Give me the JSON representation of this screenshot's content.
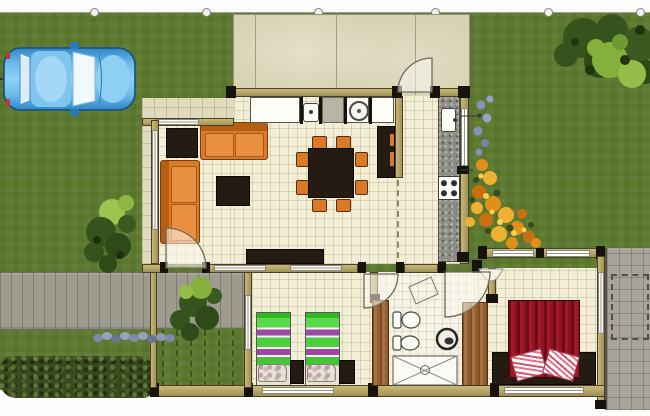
{
  "scene": {
    "kind": "residential site / floor plan, top-down colour render",
    "visible_text": "none",
    "canvas": {
      "width": 650,
      "height": 416
    }
  },
  "palette": {
    "grass": "#5d7a2f",
    "hedge": "#394920",
    "walkway": "#9d9a8e",
    "terrace": "#d8d3b4",
    "floor_tile": "#f3efd7",
    "wall_wood": "#b3a263",
    "column_dark": "#17130c",
    "sofa_orange": "#d97a28",
    "dark_furniture": "#241c12",
    "kitchen_counter": "#8d8e86",
    "car_blue": "#4aa2e0",
    "flower_orange": "#e09018",
    "bed_green": "#46d334",
    "bed_purple": "#9d48a4",
    "bed_red": "#8e1420",
    "door_wood": "#a9713f",
    "rear_patio": "#a8a49b"
  },
  "site": {
    "boundary_marker_count": 6,
    "car": "blue sedan parked on lawn, top-left",
    "walkway": "grey paved path from west boundary to front door",
    "hedge": "dark shrub hedge, lower-left",
    "shrub_row": "grey-blue shrubs along south edge of walkway",
    "west_tree": "tree beside west facade",
    "northeast_tree": "tree in north-east lawn corner",
    "flower_bed": "orange flower bed against east kitchen wall",
    "courtyard": "planted courtyard with pergola battens south of living room",
    "rear_patio": "grey paved patio east of master bedroom with dashed layout rectangle"
  },
  "house": {
    "terrace": {
      "label": "north terrace",
      "doors": [
        "kitchen swing door"
      ]
    },
    "living_room": {
      "furniture": [
        "corner table",
        "two-seat sofa (north)",
        "two-seat sofa (west)",
        "coffee table",
        "low TV sideboard"
      ]
    },
    "dining_area": {
      "furniture": [
        "square dark table",
        "8 orange chairs",
        "tall dark sideboard"
      ]
    },
    "kitchen": {
      "furniture": [
        "east stone counter",
        "sink",
        "4-burner cooktop",
        "north counter",
        "second sink",
        "round washer",
        "fridge"
      ]
    },
    "twin_bedroom": {
      "furniture": [
        "twin bed x2 green/purple bedding",
        "dark nightstand x2"
      ]
    },
    "bathroom": {
      "furniture": [
        "toilet",
        "bidet",
        "round basin",
        "shower with cross bracing"
      ]
    },
    "master_bedroom": {
      "furniture": [
        "double bed with red drape bedding",
        "dark bedside unit x2"
      ],
      "openings": [
        "east glazed door",
        "north windows",
        "curtained window"
      ]
    },
    "doors": [
      "front entrance swing",
      "twin-bedroom swing",
      "hall swing",
      "timber leaf x2"
    ]
  }
}
